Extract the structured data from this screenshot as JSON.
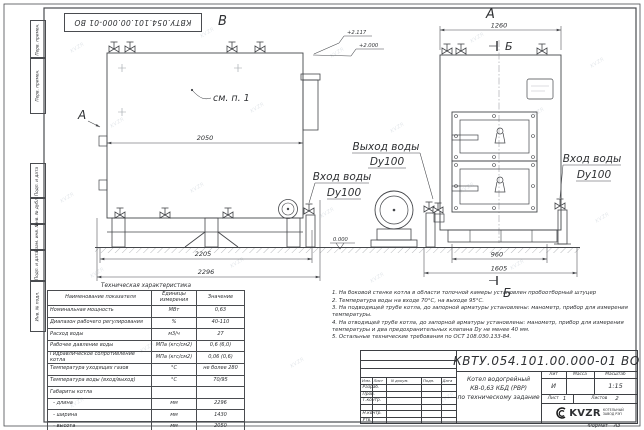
{
  "doc": {
    "number_full": "КВТУ.054.101.00.000-01  ВО",
    "format_label": "Формат",
    "format_value": "А3"
  },
  "frame_labels": {
    "b1": "Перв. примен.",
    "b2": "Перв. примен.",
    "b3": "Подп. и дата",
    "b4": "Инв. № дубл.",
    "b5": "Взам. инв. №",
    "b6": "Подп. и дата",
    "b7": "Инв. № подл."
  },
  "view_labels": {
    "side": "В",
    "front": "А",
    "arrow": "А",
    "section_top": "Б",
    "section_bottom": "Б",
    "see_note": "см. п. 1"
  },
  "dims": {
    "side_width": "2050",
    "side_base": "2205",
    "side_total": "2296",
    "front_width": "1260",
    "front_base": "960",
    "front_total": "1605"
  },
  "elevations": {
    "top": "+2.117",
    "mid": "+2.000",
    "zero": "0.000"
  },
  "pipes": {
    "outlet_line1": "Выход воды",
    "outlet_line2": "Dy100",
    "inlet_line1": "Вход воды",
    "inlet_line2": "Dy100",
    "inlet_r_line1": "Вход воды",
    "inlet_r_line2": "Dy100"
  },
  "spec_table": {
    "title": "Техническая характеристика",
    "headers": [
      "Наименование показателя",
      "Единицы измерения",
      "Значение"
    ],
    "rows": [
      [
        "Номинальная мощность",
        "МВт",
        "0,63"
      ],
      [
        "Диапазон рабочего регулирования",
        "%",
        "40-110"
      ],
      [
        "Расход воды",
        "м3/ч",
        "27"
      ],
      [
        "Рабочее давление воды",
        "МПа (кгс/см2)",
        "0,6 (6,0)"
      ],
      [
        "Гидравлическое сопротивление котла",
        "МПа (кгс/см2)",
        "0,06 (0,6)"
      ],
      [
        "Температура уходящих газов",
        "°С",
        "не более 280"
      ],
      [
        "Температура воды (вход/выход)",
        "°С",
        "70/95"
      ],
      [
        "Габариты котла",
        "",
        ""
      ],
      [
        "  - длина",
        "мм",
        "2296"
      ],
      [
        "  - ширина",
        "мм",
        "1430"
      ],
      [
        "  - высота",
        "мм",
        "2050"
      ]
    ]
  },
  "notes": [
    "1. На боковой стенке котла в области топочной камеры установлен пробоотборный штуцер",
    "2. Температура воды на входе 70°С, на выходе 95°С.",
    "3. На подводящей трубе котла, до запорной арматуры установлены: манометр, прибор для измерения температуры.",
    "4. На отводящей трубе котла, до запорной арматуры установлены: манометр, прибор для измерения температуры и два предохранительных клапана Dу не менее 40 мм.",
    "5. Остальные технические требования по ОСТ 108.030.133-84."
  ],
  "title_block": {
    "doc_number": "КВТУ.054.101.00.000-01  ВО",
    "name_line1": "Котел водогрейный",
    "name_line2": "КВ-0,63 КБД (РВР)",
    "name_line3": "по техническому задание",
    "col_izm": "Изм.",
    "col_list": "Лист",
    "col_ndoc": "N докум.",
    "col_podp": "Подп.",
    "col_data": "Дата",
    "row_razrab": "Разраб.",
    "row_prov": "Пров.",
    "row_tkontr": "Т.контр.",
    "row_nkontr": "Н.контр.",
    "row_utv": "Утв.",
    "lit_label": "Лит",
    "lit_value": "И",
    "massa_label": "Масса",
    "masshtab_label": "Масштаб",
    "scale_value": "1:15",
    "list_label": "Лист",
    "list_value": "1",
    "listov_label": "Листов",
    "listov_value": "2",
    "logo_text": "KVZR",
    "logo_sub1": "КОТЕЛЬНЫЙ",
    "logo_sub2": "ЗАВОД РЭП"
  },
  "watermark": {
    "text": "KVZR"
  }
}
